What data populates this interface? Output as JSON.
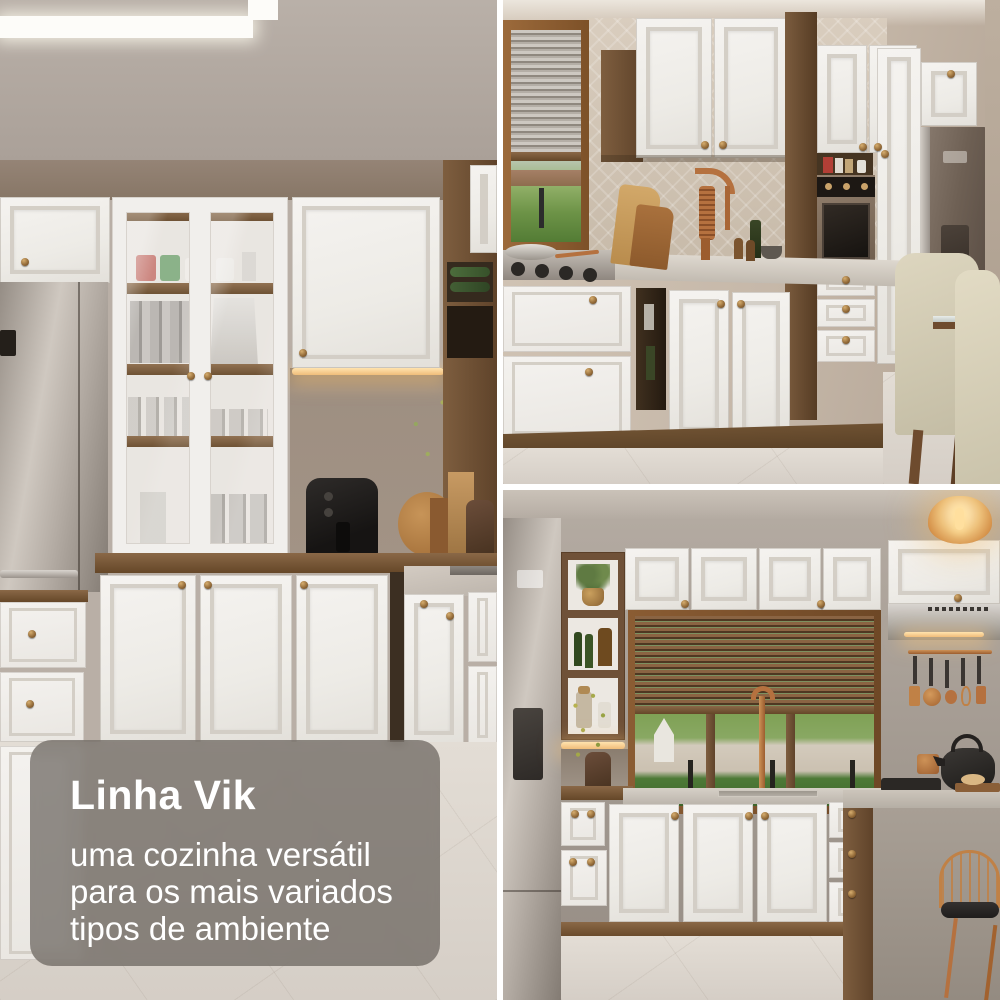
{
  "overlay": {
    "title": "Linha Vik",
    "subtitle": "uma cozinha versátil para os mais variados tipos de ambiente"
  },
  "collage": {
    "layout": "one tall photo on the left, two stacked photos on the right",
    "gutter_color": "#ffffff"
  },
  "panels": {
    "left": {
      "alt": "kitchen with glass-door hutch, stainless refrigerator, white shaker cabinets, black air fryer on wood countertop and white island drawers"
    },
    "top_right": {
      "alt": "kitchen run with wood-framed window, copper spring faucet, built-in oven tower, brown refrigerator and beige dining chairs"
    },
    "bottom_right": {
      "alt": "kitchen with wood venetian blinds, range hood, hanging copper utensils, concrete island, copper bar stool and amber pendant light"
    }
  },
  "palette": {
    "cabinet_white": "#f1efec",
    "wood_brown": "#7c5c3d",
    "copper_accent": "#b5713f",
    "wall_taupe": "#b3a9a1",
    "backsplash_beige": "#d2c5b6",
    "overlay_card": "rgba(92,86,80,0.66)",
    "text_color": "#ffffff",
    "floor": "#ddd6ce",
    "greenery": "#6f9447"
  }
}
